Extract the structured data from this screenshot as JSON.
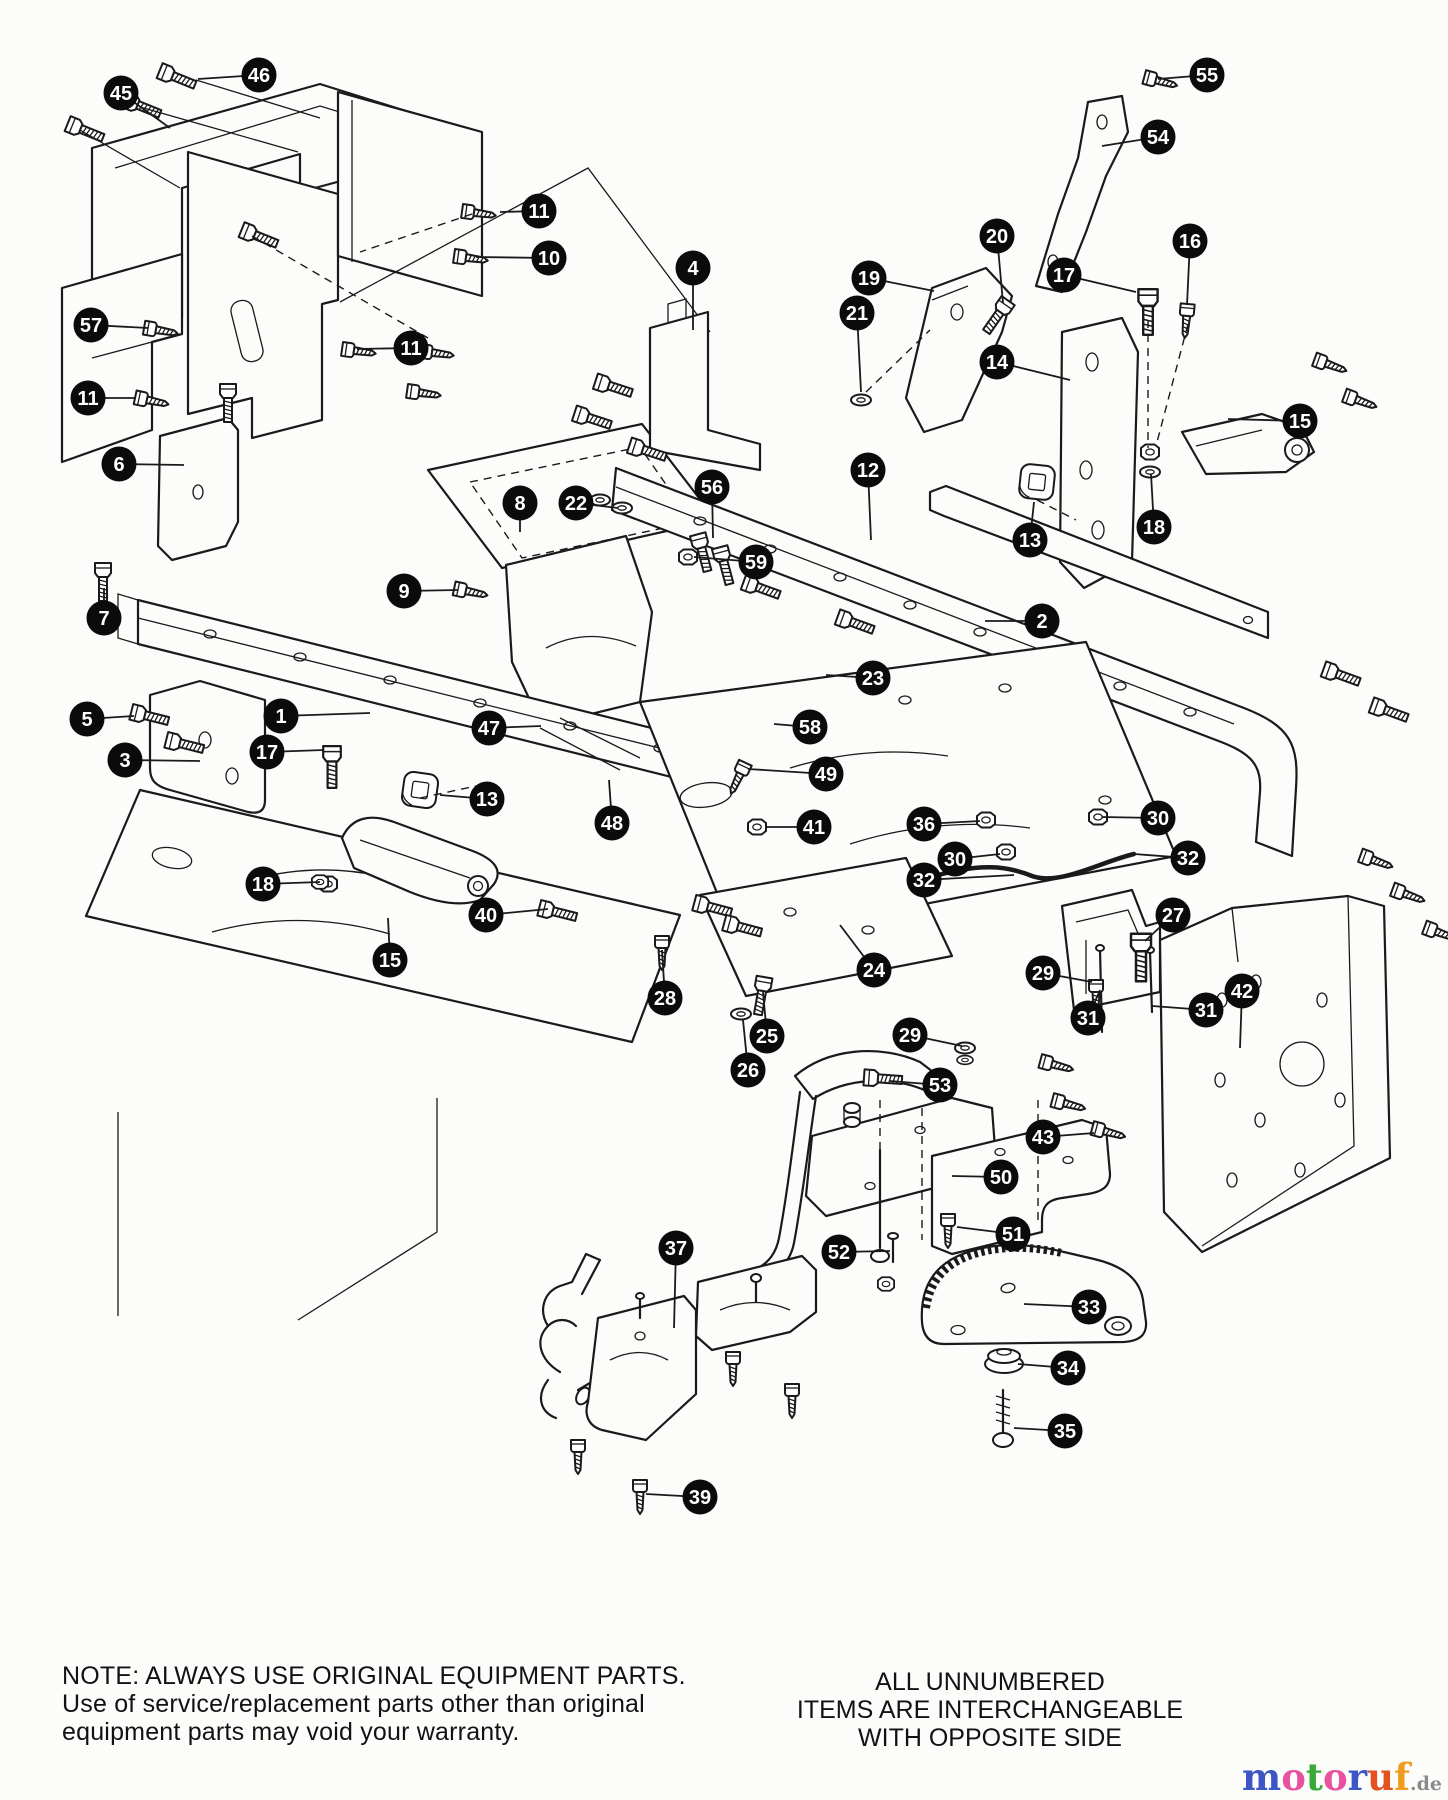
{
  "page": {
    "background": "#fcfcfa",
    "ink": "#1a1a1a"
  },
  "notes": {
    "warranty": [
      "NOTE: ALWAYS USE ORIGINAL EQUIPMENT PARTS.",
      "Use of service/replacement parts other than original",
      "equipment parts may void your warranty."
    ],
    "interchange": [
      "ALL UNNUMBERED",
      "ITEMS ARE INTERCHANGEABLE",
      "WITH OPPOSITE SIDE"
    ]
  },
  "watermark": {
    "letters": [
      {
        "ch": "m",
        "color": "#3d56c5"
      },
      {
        "ch": "o",
        "color": "#e8519f"
      },
      {
        "ch": "t",
        "color": "#38a938"
      },
      {
        "ch": "o",
        "color": "#e8519f"
      },
      {
        "ch": "r",
        "color": "#3d56c5"
      },
      {
        "ch": "u",
        "color": "#e2511f"
      },
      {
        "ch": "f",
        "color": "#f09c1e"
      }
    ],
    "suffix": ".de",
    "suffix_color": "#8a8a8a"
  },
  "callout_style": {
    "diameter": 35,
    "background": "#0b0b0b",
    "color": "#ffffff",
    "leader_color": "#1a1a1a"
  },
  "callouts": [
    {
      "n": "45",
      "x": 121,
      "y": 93,
      "lx": 170,
      "ly": 128
    },
    {
      "n": "46",
      "x": 259,
      "y": 75,
      "lx": 198,
      "ly": 79
    },
    {
      "n": "55",
      "x": 1207,
      "y": 75,
      "lx": 1158,
      "ly": 79
    },
    {
      "n": "54",
      "x": 1158,
      "y": 137,
      "lx": 1102,
      "ly": 146
    },
    {
      "n": "11",
      "x": 539,
      "y": 211,
      "lx": 500,
      "ly": 212
    },
    {
      "n": "10",
      "x": 549,
      "y": 258,
      "lx": 476,
      "ly": 257
    },
    {
      "n": "4",
      "x": 693,
      "y": 268,
      "lx": 693,
      "ly": 330
    },
    {
      "n": "20",
      "x": 997,
      "y": 236,
      "lx": 1003,
      "ly": 303
    },
    {
      "n": "16",
      "x": 1190,
      "y": 241,
      "lx": 1187,
      "ly": 305
    },
    {
      "n": "19",
      "x": 869,
      "y": 278,
      "lx": 934,
      "ly": 291
    },
    {
      "n": "17",
      "x": 1064,
      "y": 275,
      "lx": 1136,
      "ly": 292
    },
    {
      "n": "21",
      "x": 857,
      "y": 313,
      "lx": 861,
      "ly": 392
    },
    {
      "n": "57",
      "x": 91,
      "y": 325,
      "lx": 148,
      "ly": 328
    },
    {
      "n": "11",
      "x": 411,
      "y": 348,
      "lx": 357,
      "ly": 349
    },
    {
      "n": "14",
      "x": 997,
      "y": 362,
      "lx": 1070,
      "ly": 380
    },
    {
      "n": "11",
      "x": 88,
      "y": 398,
      "lx": 136,
      "ly": 398
    },
    {
      "n": "15",
      "x": 1300,
      "y": 421,
      "lx": 1228,
      "ly": 419
    },
    {
      "n": "6",
      "x": 119,
      "y": 464,
      "lx": 184,
      "ly": 465
    },
    {
      "n": "12",
      "x": 868,
      "y": 470,
      "lx": 871,
      "ly": 540
    },
    {
      "n": "8",
      "x": 520,
      "y": 503,
      "lx": 520,
      "ly": 532
    },
    {
      "n": "22",
      "x": 576,
      "y": 503,
      "lx": 618,
      "ly": 508
    },
    {
      "n": "56",
      "x": 712,
      "y": 487,
      "lx": 713,
      "ly": 538
    },
    {
      "n": "13",
      "x": 1030,
      "y": 540,
      "lx": 1034,
      "ly": 502
    },
    {
      "n": "18",
      "x": 1154,
      "y": 527,
      "lx": 1151,
      "ly": 474
    },
    {
      "n": "59",
      "x": 756,
      "y": 562,
      "lx": 694,
      "ly": 557
    },
    {
      "n": "9",
      "x": 404,
      "y": 591,
      "lx": 458,
      "ly": 590
    },
    {
      "n": "7",
      "x": 104,
      "y": 618,
      "lx": 104,
      "ly": 588
    },
    {
      "n": "2",
      "x": 1042,
      "y": 621,
      "lx": 985,
      "ly": 621
    },
    {
      "n": "23",
      "x": 873,
      "y": 678,
      "lx": 826,
      "ly": 675
    },
    {
      "n": "5",
      "x": 87,
      "y": 719,
      "lx": 134,
      "ly": 716
    },
    {
      "n": "1",
      "x": 281,
      "y": 716,
      "lx": 370,
      "ly": 713
    },
    {
      "n": "17",
      "x": 267,
      "y": 752,
      "lx": 324,
      "ly": 750
    },
    {
      "n": "3",
      "x": 125,
      "y": 760,
      "lx": 200,
      "ly": 761
    },
    {
      "n": "47",
      "x": 489,
      "y": 728,
      "lx": 541,
      "ly": 726
    },
    {
      "n": "58",
      "x": 810,
      "y": 727,
      "lx": 774,
      "ly": 724
    },
    {
      "n": "13",
      "x": 487,
      "y": 799,
      "lx": 440,
      "ly": 795
    },
    {
      "n": "49",
      "x": 826,
      "y": 774,
      "lx": 748,
      "ly": 769
    },
    {
      "n": "41",
      "x": 814,
      "y": 827,
      "lx": 766,
      "ly": 827
    },
    {
      "n": "36",
      "x": 924,
      "y": 824,
      "lx": 980,
      "ly": 821
    },
    {
      "n": "30",
      "x": 1158,
      "y": 818,
      "lx": 1102,
      "ly": 817
    },
    {
      "n": "30",
      "x": 955,
      "y": 859,
      "lx": 1000,
      "ly": 854
    },
    {
      "n": "32",
      "x": 924,
      "y": 880,
      "lx": 1014,
      "ly": 875
    },
    {
      "n": "32",
      "x": 1188,
      "y": 858,
      "lx": 1134,
      "ly": 854
    },
    {
      "n": "27",
      "x": 1173,
      "y": 915,
      "lx": 1145,
      "ly": 941
    },
    {
      "n": "18",
      "x": 263,
      "y": 884,
      "lx": 320,
      "ly": 882
    },
    {
      "n": "40",
      "x": 486,
      "y": 915,
      "lx": 548,
      "ly": 909
    },
    {
      "n": "15",
      "x": 390,
      "y": 960,
      "lx": 388,
      "ly": 918
    },
    {
      "n": "48",
      "x": 612,
      "y": 823,
      "lx": 609,
      "ly": 780
    },
    {
      "n": "28",
      "x": 665,
      "y": 998,
      "lx": 662,
      "ly": 950
    },
    {
      "n": "24",
      "x": 874,
      "y": 970,
      "lx": 840,
      "ly": 925
    },
    {
      "n": "29",
      "x": 1043,
      "y": 973,
      "lx": 1092,
      "ly": 982
    },
    {
      "n": "25",
      "x": 767,
      "y": 1036,
      "lx": 763,
      "ly": 992
    },
    {
      "n": "29",
      "x": 910,
      "y": 1035,
      "lx": 962,
      "ly": 1046
    },
    {
      "n": "31",
      "x": 1088,
      "y": 1018,
      "lx": 1100,
      "ly": 990
    },
    {
      "n": "31",
      "x": 1206,
      "y": 1010,
      "lx": 1152,
      "ly": 1006
    },
    {
      "n": "42",
      "x": 1242,
      "y": 991,
      "lx": 1240,
      "ly": 1048
    },
    {
      "n": "26",
      "x": 748,
      "y": 1070,
      "lx": 743,
      "ly": 1020
    },
    {
      "n": "53",
      "x": 940,
      "y": 1085,
      "lx": 890,
      "ly": 1081
    },
    {
      "n": "43",
      "x": 1043,
      "y": 1137,
      "lx": 1094,
      "ly": 1133
    },
    {
      "n": "50",
      "x": 1001,
      "y": 1177,
      "lx": 952,
      "ly": 1176
    },
    {
      "n": "51",
      "x": 1013,
      "y": 1234,
      "lx": 957,
      "ly": 1227
    },
    {
      "n": "37",
      "x": 676,
      "y": 1248,
      "lx": 674,
      "ly": 1328
    },
    {
      "n": "52",
      "x": 839,
      "y": 1252,
      "lx": 890,
      "ly": 1251
    },
    {
      "n": "33",
      "x": 1089,
      "y": 1307,
      "lx": 1024,
      "ly": 1304
    },
    {
      "n": "34",
      "x": 1068,
      "y": 1368,
      "lx": 1018,
      "ly": 1364
    },
    {
      "n": "35",
      "x": 1065,
      "y": 1431,
      "lx": 1014,
      "ly": 1428
    },
    {
      "n": "39",
      "x": 700,
      "y": 1497,
      "lx": 646,
      "ly": 1494
    }
  ]
}
